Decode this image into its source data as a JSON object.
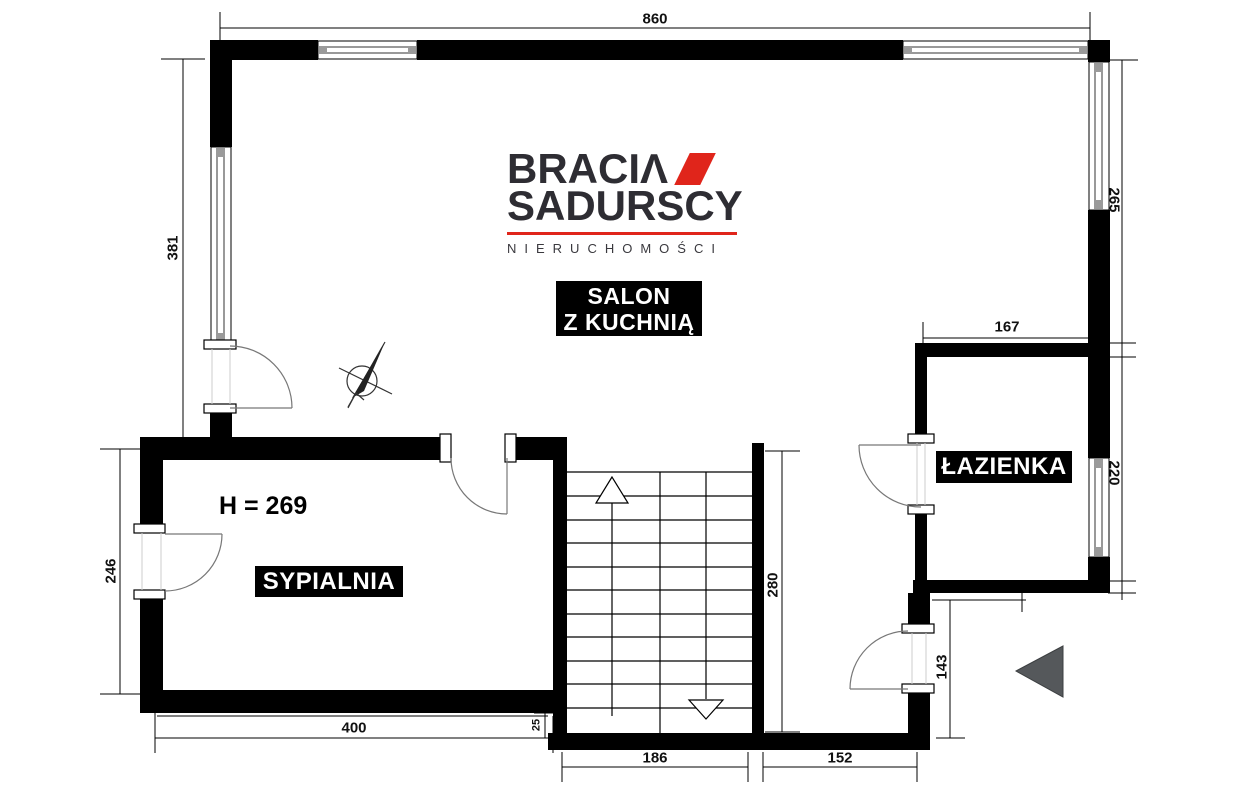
{
  "logo": {
    "brand_line1": "BRACIΛ",
    "brand_line2": "SADURSCY",
    "tagline": "NIERUCHOMOŚCI",
    "accent_color": "#e0251b"
  },
  "rooms": {
    "living": {
      "line1": "SALON",
      "line2": "Z KUCHNIĄ"
    },
    "bedroom": "SYPIALNIA",
    "bathroom": "ŁAZIENKA"
  },
  "notes": {
    "ceiling_height": "H = 269"
  },
  "dimensions": {
    "top_width": "860",
    "left_upper": "381",
    "left_lower": "246",
    "bedroom_width": "400",
    "gap": "25",
    "stairs_width": "186",
    "entry_width": "152",
    "stairs_depth": "280",
    "entry_depth": "143",
    "bathroom_width": "167",
    "right_window_upper": "265",
    "right_window_lower": "220"
  },
  "colors": {
    "wall": "#000000",
    "accent_red": "#e0251b",
    "entry_arrow": "#55585b",
    "room_label_bg": "#000000",
    "room_label_text": "#ffffff"
  }
}
